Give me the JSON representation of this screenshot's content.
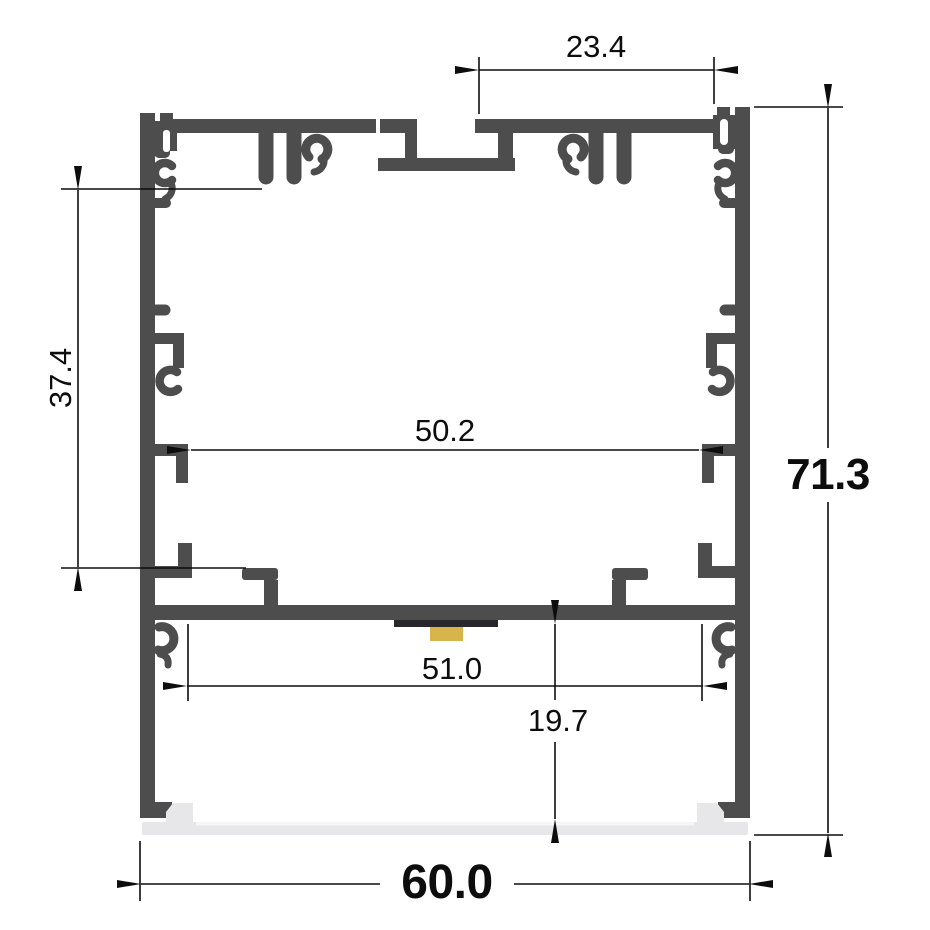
{
  "dims": {
    "top_width": "23.4",
    "side_height": "37.4",
    "inner_width_upper": "50.2",
    "inner_width_lower": "51.0",
    "cavity_depth": "19.7",
    "overall_height": "71.3",
    "overall_width": "60.0"
  },
  "colors": {
    "background": "#ffffff",
    "profile": "#4d4d4e",
    "dimension": "#0d0d0d",
    "diffuser": "#e7e7ea",
    "diffuser_highlight": "#f6f6f8",
    "pcb": "#28282c",
    "led_chip": "#d8b54a"
  }
}
